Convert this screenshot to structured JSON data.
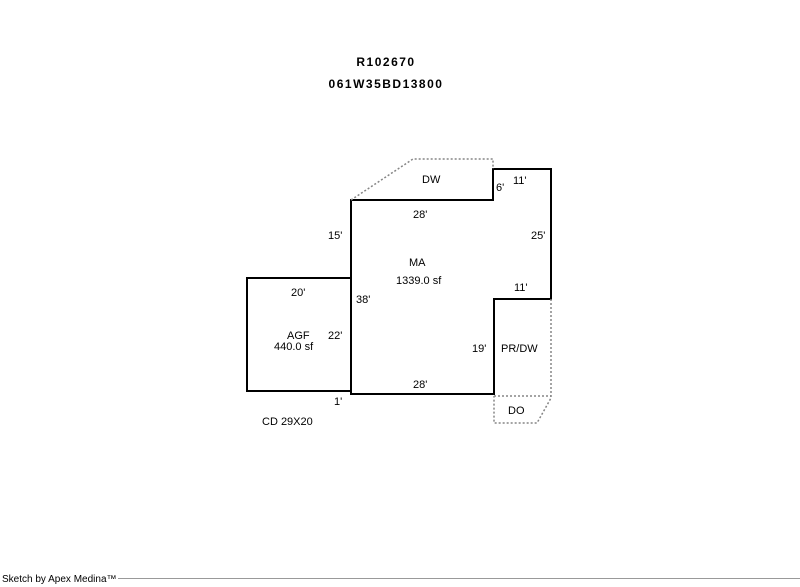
{
  "header": {
    "line1": "R102670",
    "line2": "061W35BD13800"
  },
  "sketch": {
    "labels": {
      "dw": "DW",
      "ma": "MA",
      "ma_area": "1339.0 sf",
      "agf": "AGF",
      "agf_area": "440.0 sf",
      "pr_dw": "PR/DW",
      "do": "DO",
      "cd": "CD 29X20"
    },
    "dimensions": {
      "top_11": "11'",
      "notch_6": "6'",
      "top_28": "28'",
      "left_15": "15'",
      "right_25": "25'",
      "right_11": "11'",
      "left_38": "38'",
      "agf_top_20": "20'",
      "agf_right_22": "22'",
      "pr_19": "19'",
      "bottom_28": "28'",
      "jog_1": "1'"
    }
  },
  "footer": {
    "credit": "Sketch by Apex Medina™"
  }
}
